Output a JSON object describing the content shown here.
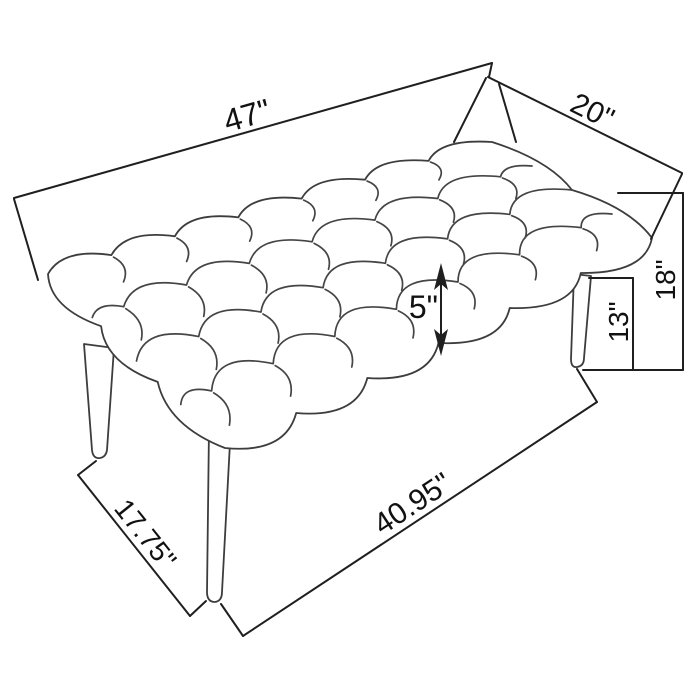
{
  "diagram": {
    "product": "Tufted upholstered accent bench",
    "view": "three-quarter perspective line drawing with dimensions",
    "unit": "inches",
    "colors": {
      "background": "#ffffff",
      "sketch_line": "#454545",
      "dimension_line": "#1f1f1f",
      "label_text": "#111111"
    },
    "labels": {
      "length": "47\"",
      "depth": "20\"",
      "height": "18\"",
      "leg_height": "13\"",
      "cushion_thickness": "5\"",
      "leg_span_side": "17.75\"",
      "leg_span_front": "40.95\""
    }
  }
}
